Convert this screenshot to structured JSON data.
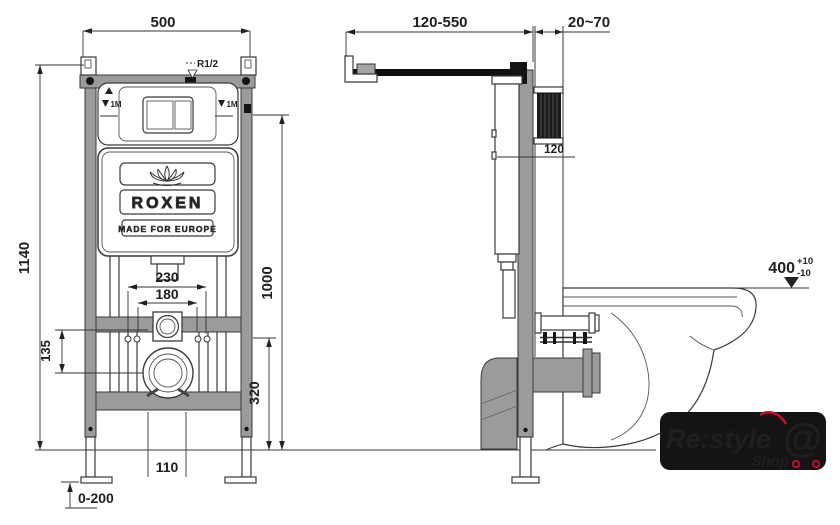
{
  "front_view": {
    "dim_width_top": "500",
    "dim_total_height": "1140",
    "dim_level_height": "1000",
    "dim_fixing_spacing_outer": "230",
    "dim_fixing_spacing_inner": "180",
    "dim_drain_offset": "135",
    "dim_fixing_height": "320",
    "dim_outlet_width": "110",
    "dim_foot_adjust": "0-200",
    "label_water_inlet": "R1/2",
    "label_level_mark": "1M",
    "cistern_brand": "ROXEN",
    "cistern_slogan": "MADE FOR EUROPE"
  },
  "side_view": {
    "dim_supply_pipe": "120-550",
    "dim_wall_offset": "20~70",
    "dim_frame_depth": "120",
    "dim_bowl_height": "400",
    "dim_bowl_height_tol_plus": "+10",
    "dim_bowl_height_tol_minus": "-10"
  },
  "logo": {
    "brand": "Re:style",
    "sub": "Shop",
    "at_symbol": "@"
  },
  "colors": {
    "line": "#3a3a3a",
    "steel_gray": "#9b9b9b",
    "black_part": "#141414",
    "logo_red": "#c8102e",
    "paper": "#ffffff"
  }
}
